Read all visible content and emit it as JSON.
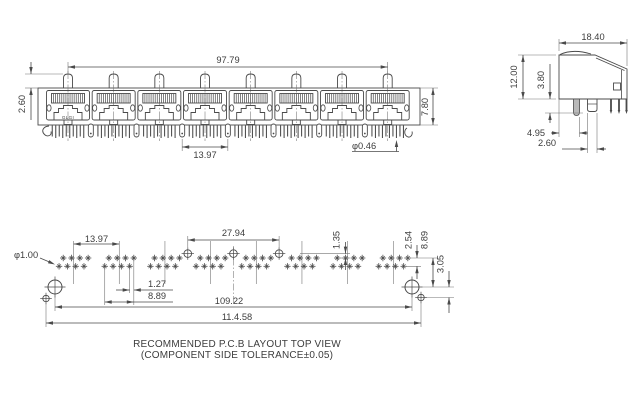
{
  "drawing": {
    "background": "#ffffff",
    "line_color": "#4a4a4a",
    "thin_line_color": "#757575",
    "brand_mark": "GLGI",
    "front_view": {
      "port_count": 8,
      "dims": {
        "overall_width": "97.79",
        "peg_height": "2.60",
        "body_height": "7.80",
        "port_pitch": "13.97",
        "pin_diameter": "φ0.46"
      }
    },
    "side_view": {
      "dims": {
        "depth": "18.40",
        "height": "12.00",
        "pin_length": "3.80",
        "peg_offset": "4.95",
        "leg_width": "2.60"
      }
    },
    "pcb_layout": {
      "group_count": 8,
      "pins_per_group": 8,
      "shield_pad_count": 3,
      "dims": {
        "hole_diameter": "φ1.00",
        "group_pitch": "13.97",
        "shield_pad_pitch": "27.94",
        "shield_pad_offset": "1.35",
        "row_spacing": "2.54",
        "row_to_hole": "8.89",
        "hole_to_pad": "3.05",
        "pin_stagger": "1.27",
        "group_span": "8.89",
        "mount_hole_spacing": "109.22",
        "outer_pad_spacing": "11.4.58"
      }
    },
    "caption": {
      "line1": "RECOMMENDED P.C.B LAYOUT TOP VIEW",
      "line2": "(COMPONENT SIDE TOLERANCE±0.05)"
    }
  }
}
